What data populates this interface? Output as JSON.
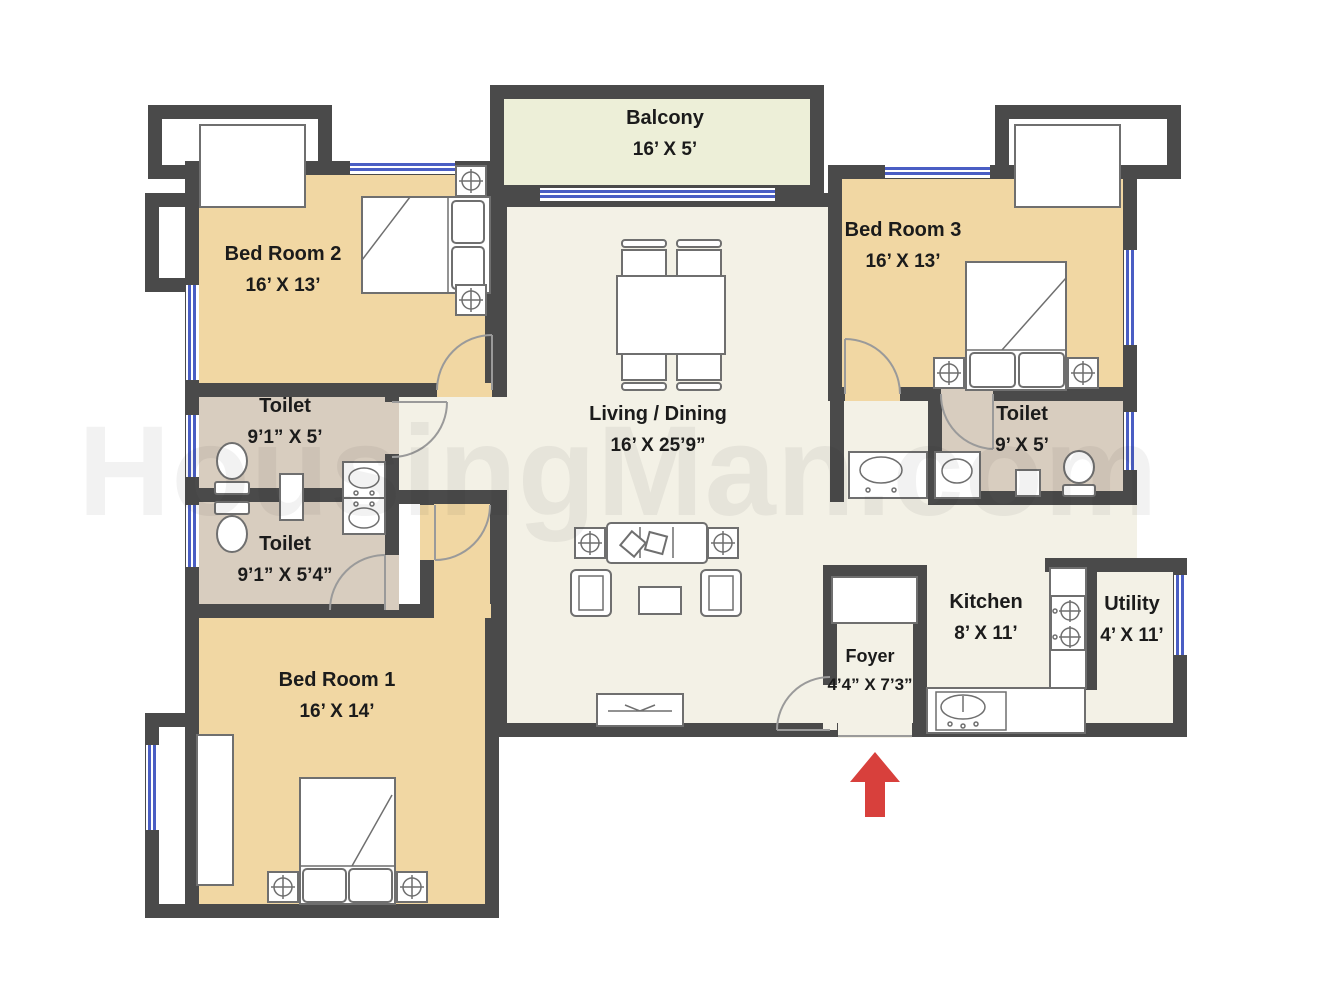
{
  "watermark": "HousingMan.com",
  "colors": {
    "wall": "#4a4a4a",
    "bedroom": "#f1d7a3",
    "toilet": "#d8cdbf",
    "living": "#f3f1e6",
    "balcony": "#edefd8",
    "window": "#4a5ec4",
    "arrow": "#d8403c",
    "furn": "#6f6f6f",
    "text": "#1b1b1b"
  },
  "rooms": {
    "balcony": {
      "name": "Balcony",
      "dims": "16’ X 5’"
    },
    "bedroom2": {
      "name": "Bed Room 2",
      "dims": "16’ X 13’"
    },
    "bedroom3": {
      "name": "Bed Room 3",
      "dims": "16’ X 13’"
    },
    "toilet_top_left": {
      "name": "Toilet",
      "dims": "9’1” X 5’"
    },
    "toilet_bottom_left": {
      "name": "Toilet",
      "dims": "9’1” X 5’4”"
    },
    "toilet_right": {
      "name": "Toilet",
      "dims": "9’ X 5’"
    },
    "living": {
      "name": "Living / Dining",
      "dims": "16’ X 25’9”"
    },
    "kitchen": {
      "name": "Kitchen",
      "dims": "8’ X 11’"
    },
    "utility": {
      "name": "Utility",
      "dims": "4’ X 11’"
    },
    "foyer": {
      "name": "Foyer",
      "dims": "4’4” X 7’3”"
    },
    "bedroom1": {
      "name": "Bed Room 1",
      "dims": "16’ X 14’"
    }
  }
}
